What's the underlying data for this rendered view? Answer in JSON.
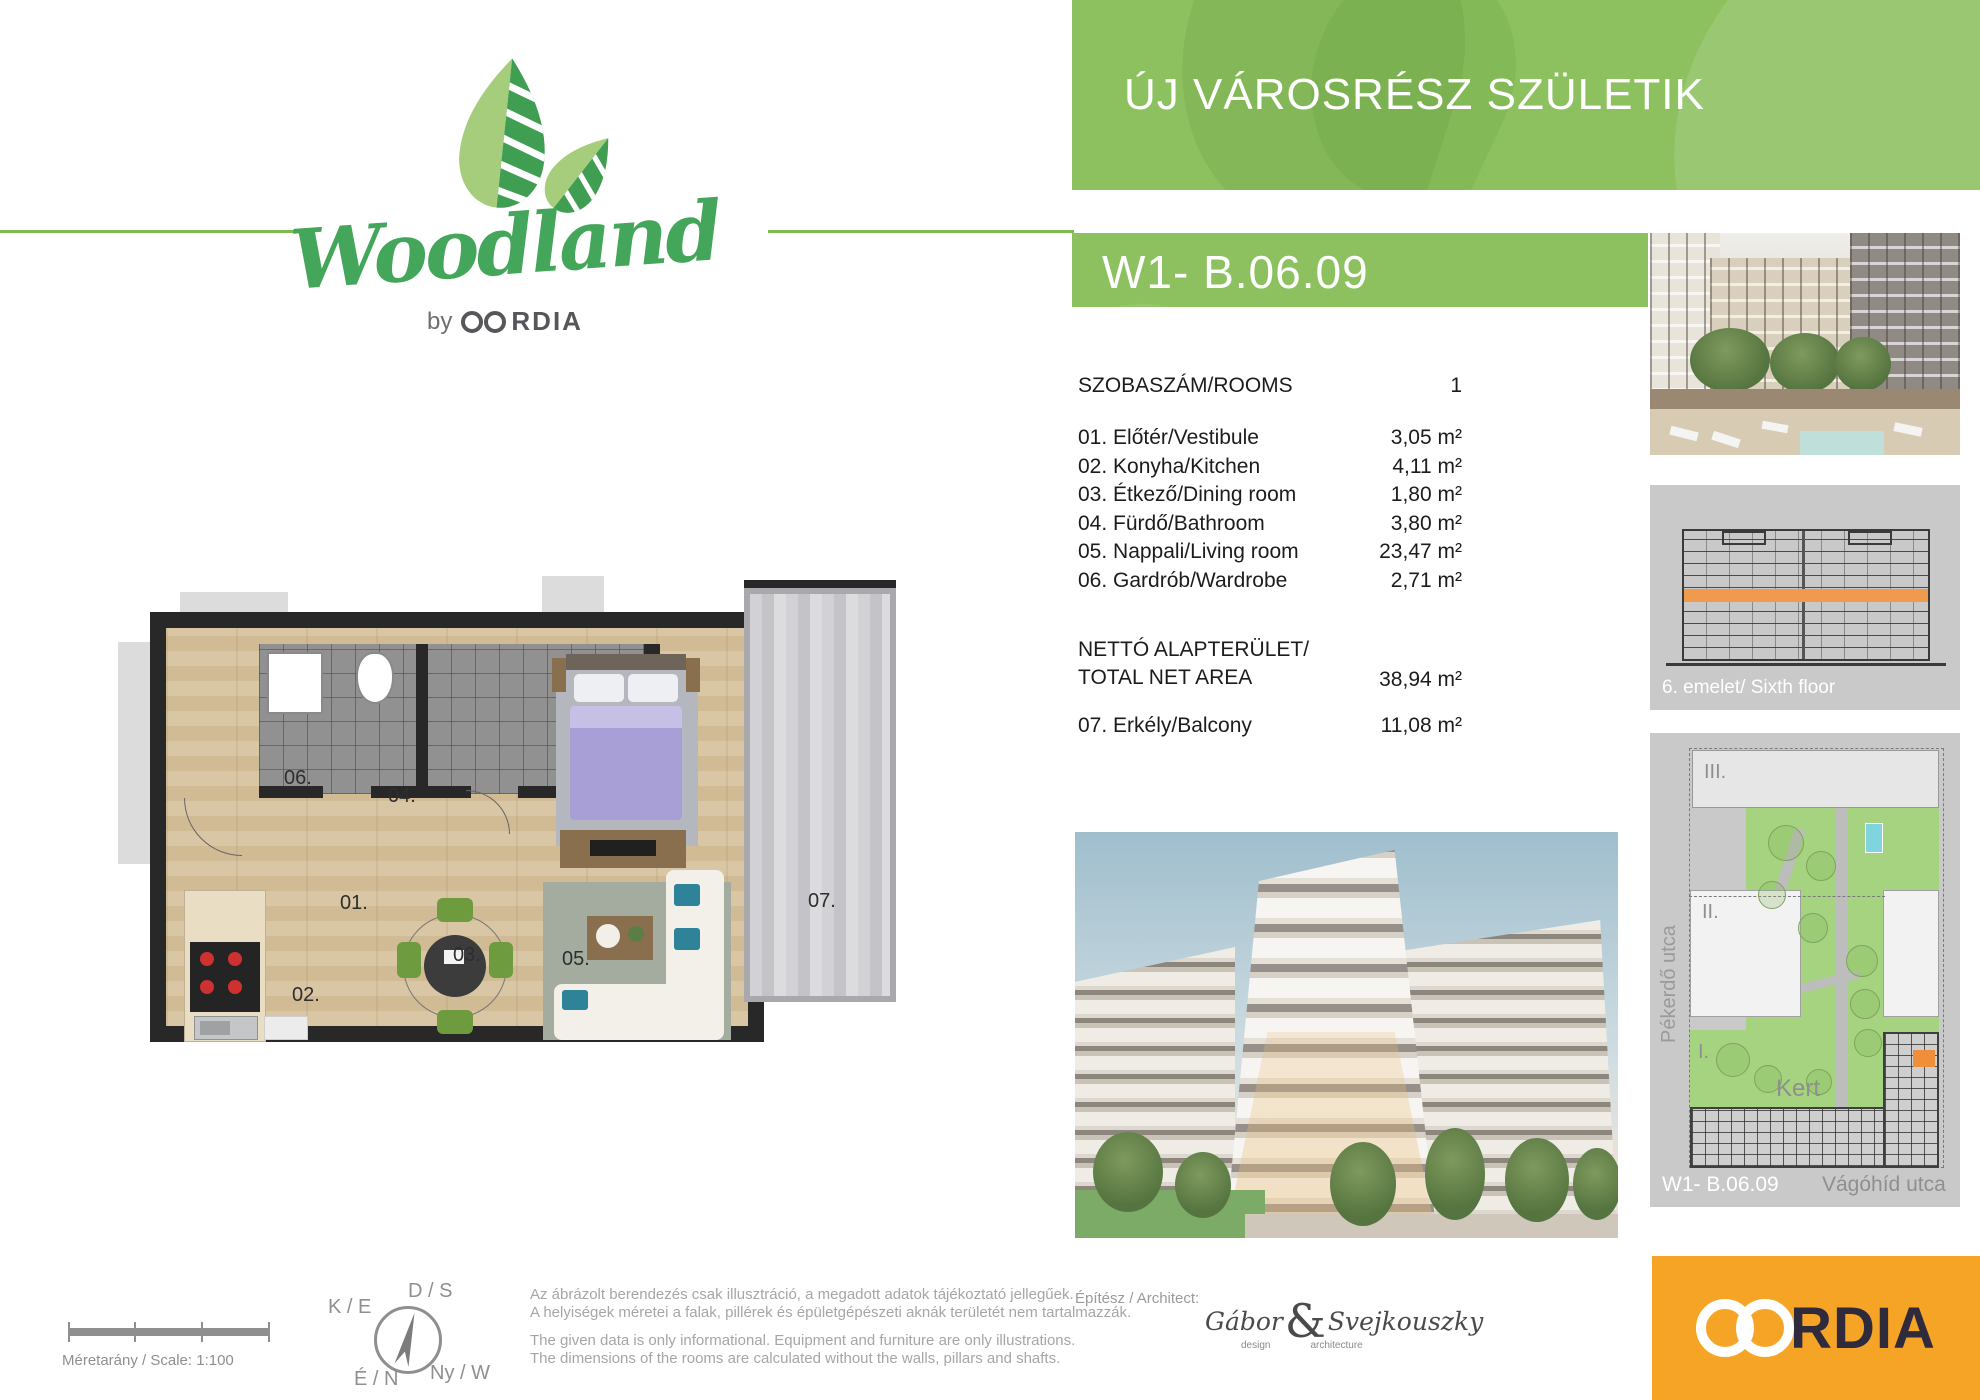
{
  "logo": {
    "brand": "Woodland",
    "by": "by",
    "company": "CORDIA",
    "company_suffix": "RDIA"
  },
  "banners": {
    "headline": "ÚJ VÁROSRÉSZ SZÜLETIK",
    "unit": "W1- B.06.09"
  },
  "rooms": {
    "header_label": "SZOBASZÁM/ROOMS",
    "header_value": "1",
    "items": [
      {
        "label": "01. Előtér/Vestibule",
        "area": "3,05 m²"
      },
      {
        "label": "02. Konyha/Kitchen",
        "area": "4,11 m²"
      },
      {
        "label": "03. Étkező/Dining room",
        "area": "1,80 m²"
      },
      {
        "label": "04. Fürdő/Bathroom",
        "area": "3,80 m²"
      },
      {
        "label": "05. Nappali/Living room",
        "area": "23,47 m²"
      },
      {
        "label": "06. Gardrób/Wardrobe",
        "area": "2,71 m²"
      }
    ],
    "net_label_line1": "NETTÓ ALAPTERÜLET/",
    "net_label_line2": "TOTAL NET AREA",
    "net_value": "38,94 m²",
    "balcony_label": "07. Erkély/Balcony",
    "balcony_value": "11,08 m²"
  },
  "floorplan": {
    "room01": "01.",
    "room02": "02.",
    "room03": "03.",
    "room04": "04.",
    "room05": "05.",
    "room06": "06.",
    "room07": "07."
  },
  "sidebar": {
    "floor_caption": "6. emelet/ Sixth floor",
    "siteplan": {
      "building_3": "III.",
      "building_2": "II.",
      "building_1": "I.",
      "garden_label": "Kert",
      "street_left": "Pékerdő utca",
      "street_bottom": "Vágóhíd utca",
      "unit_label": "W1- B.06.09"
    }
  },
  "footer": {
    "scale_label": "Méretarány / Scale: 1:100",
    "compass": {
      "top": "D / S",
      "left": "K / E",
      "bottom": "É / N",
      "right": "Ny / W"
    },
    "disclaimer_hu_1": "Az ábrázolt berendezés csak illusztráció, a megadott adatok tájékoztató jellegűek.",
    "disclaimer_hu_2": "A helyiségek méretei a falak, pillérek és épületgépészeti aknák területét nem tartalmazzák.",
    "disclaimer_en_1": "The given data is only informational. Equipment and furniture are only illustrations.",
    "disclaimer_en_2": "The dimensions of the rooms are calculated without the walls, pillars and shafts.",
    "architect_label": "Építész / Architect:",
    "architect_first": "Gábor",
    "architect_amp": "&",
    "architect_last": "Svejkouszky",
    "architect_sub_1": "design",
    "architect_sub_2": "architecture",
    "cordia": "CORDIA",
    "cordia_suffix": "RDIA"
  },
  "colors": {
    "banner_green": "#8dc15f",
    "rule_green": "#7eba52",
    "accent_orange": "#f6a425",
    "floor_highlight": "#ef9a4d",
    "site_green": "#a5d37f",
    "pool_cyan": "#7fd4dd",
    "cordia_dark": "#2f2b3c"
  }
}
